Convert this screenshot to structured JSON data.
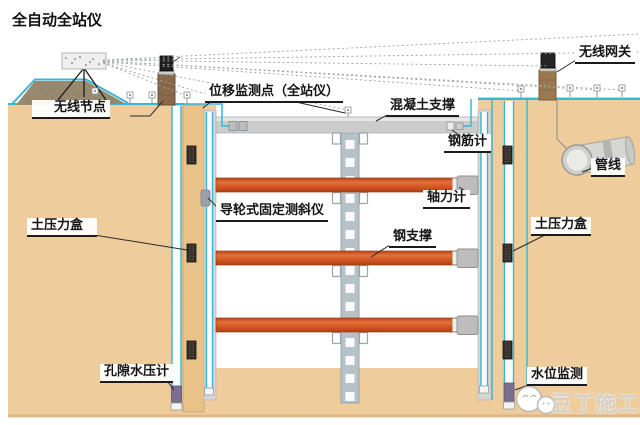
{
  "labels": {
    "total_station": "全自动全站仪",
    "wireless_node": "无线节点",
    "displacement_point": "位移监测点（全站仪）",
    "concrete_support": "混凝土支撑",
    "rebar_meter": "钢筋计",
    "wireless_gateway": "无线网关",
    "pipeline": "管线",
    "axial_force_meter": "轴力计",
    "fixed_inclinometer": "导轮式固定测斜仪",
    "steel_support": "钢支撑",
    "earth_pressure_left": "土压力盒",
    "earth_pressure_right": "土压力盒",
    "pore_water_pressure": "孔隙水压计",
    "water_level": "水位监测",
    "watermark": "豆丁施工"
  },
  "icons": {
    "logo": "douding-chat-faces-icon",
    "total_station": "total-station-tripod-icon",
    "survey_prism": "survey-prism-target-icon",
    "wireless_node_device": "wireless-node-antenna-icon",
    "wireless_gateway_device": "wireless-gateway-antenna-icon"
  },
  "colors": {
    "sand": "#f2cfa0",
    "wall_tan": "#e9c28a",
    "strut_orange": "#d4581f",
    "cable_cyan": "#3ab5d4",
    "concrete_gray": "#cbcbcb",
    "column_gray": "#b7c2c8",
    "purple_tip": "#7b6e91",
    "watermark_gray": "#d5d0c7"
  }
}
